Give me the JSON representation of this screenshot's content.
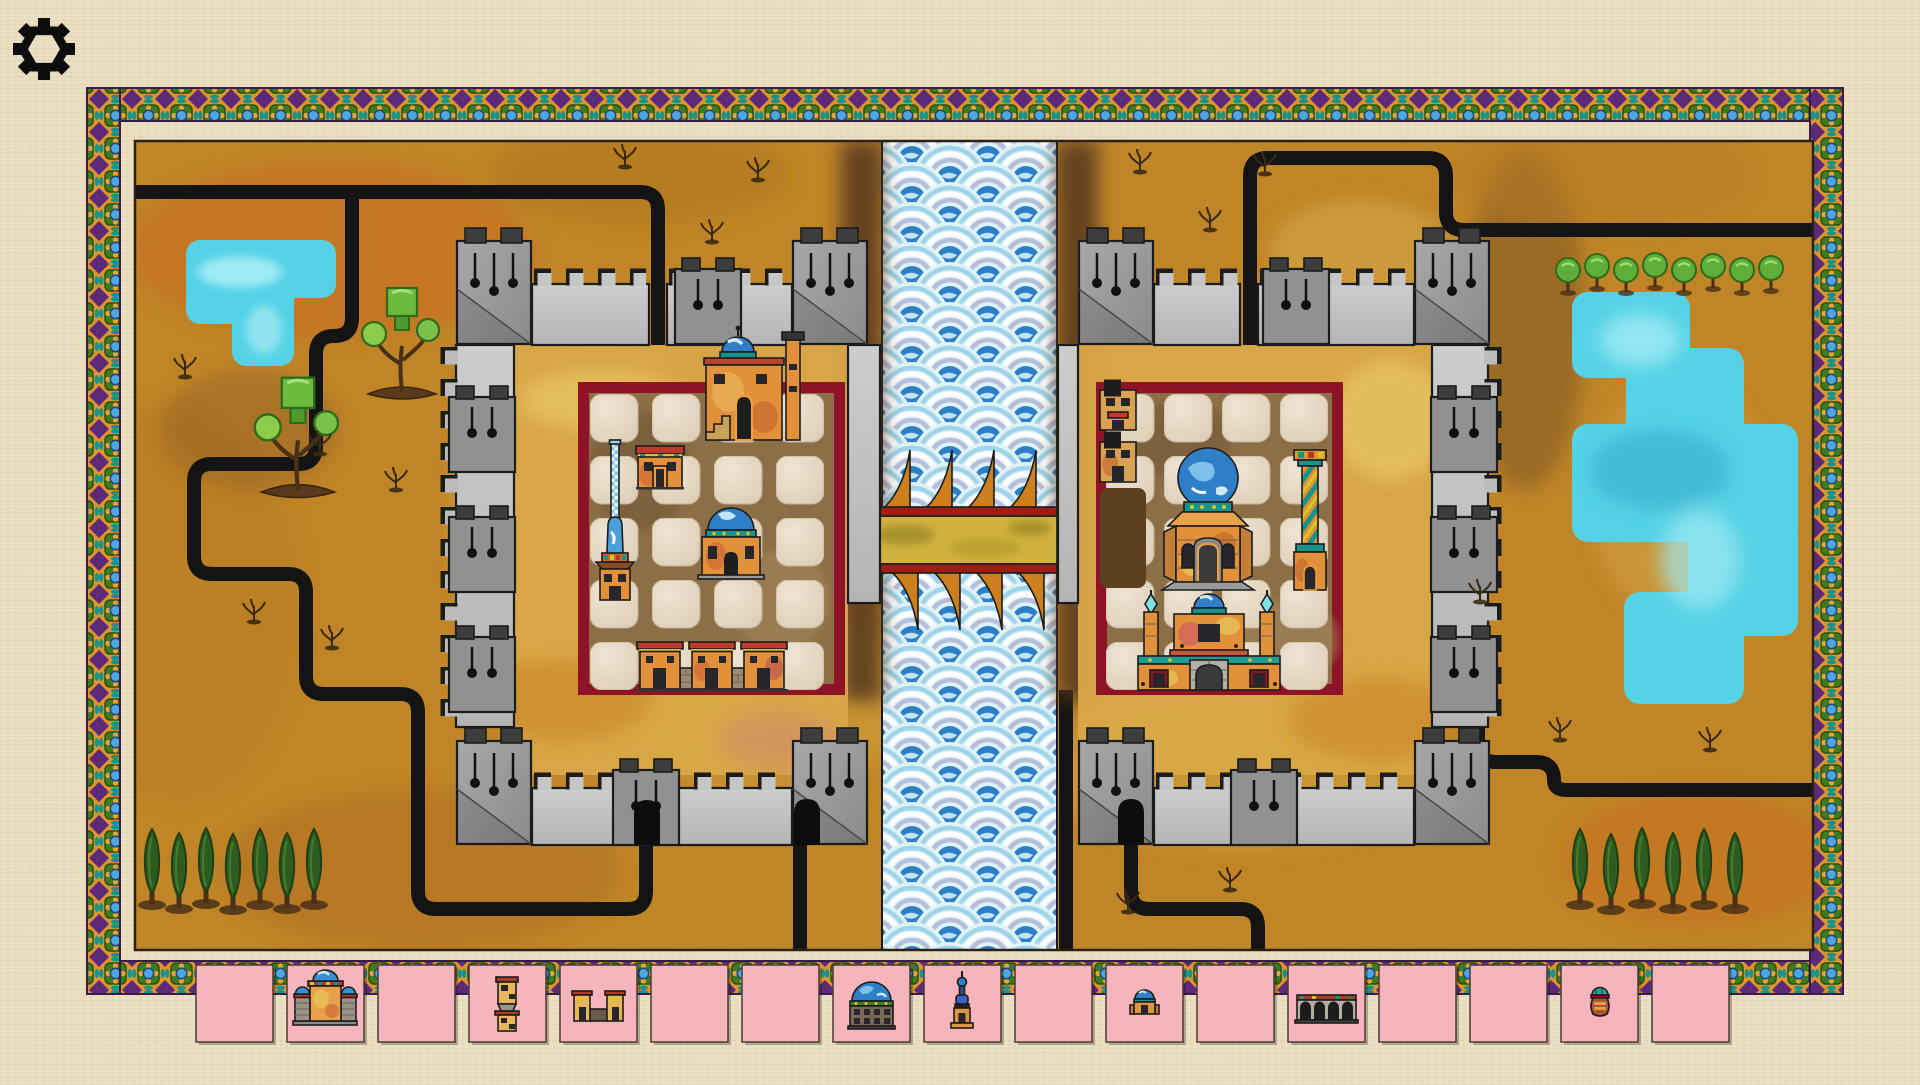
{
  "app": {
    "name": "Desert cities route-building board game",
    "background_color": "#ece0c3"
  },
  "toolbar": {
    "settings_icon": "gear"
  },
  "palette": {
    "paper": "#ece0c3",
    "board_gold": "#c08527",
    "road_black": "#141414",
    "lake_cyan": "#55d2e6",
    "river_blue": "#2e7fc8",
    "river_pale": "#dff2f7",
    "wall_light": "#c6c6c6",
    "wall_mid": "#9c9c9c",
    "battlement_dark": "#3d3d3d",
    "city_border_red": "#8e1326",
    "plaza_brown": "#8d6f47",
    "tile_slot": "#e9dcc9",
    "card_pink": "#f6b5bc",
    "bridge_gold": "#d2b23e",
    "bridge_red": "#9e1d15",
    "bridge_sail": "#cc7f1c",
    "frame_gold": "#e0942d",
    "frame_purple": "#5c2a78",
    "frame_green": "#3e7b1f",
    "frame_blue": "#4da6e0",
    "frame_teal": "#17948a",
    "tree_green": "#6cbb3c",
    "cypress_green": "#2e5c20",
    "building_orange": "#e2913a",
    "dome_blue": "#2e7fc8"
  },
  "board": {
    "left_province": {
      "features": [
        "stepped-lake",
        "ornamental-trees",
        "shrub-sprigs",
        "cypress-row",
        "winding-roads"
      ]
    },
    "river": {
      "style": "seigaiha-waves",
      "bridge": {
        "deck": "gold-planks",
        "rails": "red",
        "sails_top": 4,
        "sails_bottom": 4
      }
    },
    "right_province": {
      "features": [
        "round-tree-row",
        "stepped-lake",
        "shrub-sprigs",
        "cypress-row",
        "winding-roads"
      ]
    },
    "left_city": {
      "wall": "stone-with-towers",
      "gates": [
        "north",
        "south-west",
        "south-east"
      ],
      "plaza_slots": 20,
      "buildings": [
        {
          "name": "minaret"
        },
        {
          "name": "small-house"
        },
        {
          "name": "domed-house-with-chimney"
        },
        {
          "name": "domed-pavilion"
        },
        {
          "name": "row-houses"
        }
      ]
    },
    "right_city": {
      "wall": "stone-with-towers",
      "gates": [
        "north",
        "south",
        "south-outer"
      ],
      "plaza_slots": 20,
      "buildings": [
        {
          "name": "watchtowers"
        },
        {
          "name": "cleared-plot"
        },
        {
          "name": "great-domed-shrine"
        },
        {
          "name": "striped-column"
        },
        {
          "name": "gate-palace"
        }
      ]
    }
  },
  "market": {
    "cards": [
      {
        "slot": 1,
        "item": null
      },
      {
        "slot": 2,
        "item": "domed-palace"
      },
      {
        "slot": 3,
        "item": null
      },
      {
        "slot": 4,
        "item": "watchtower"
      },
      {
        "slot": 5,
        "item": "twin-tower-gate"
      },
      {
        "slot": 6,
        "item": null
      },
      {
        "slot": 7,
        "item": null
      },
      {
        "slot": 8,
        "item": "great-dome"
      },
      {
        "slot": 9,
        "item": "minaret"
      },
      {
        "slot": 10,
        "item": null
      },
      {
        "slot": 11,
        "item": "small-domed-house"
      },
      {
        "slot": 12,
        "item": null
      },
      {
        "slot": 13,
        "item": "aqueduct"
      },
      {
        "slot": 14,
        "item": null
      },
      {
        "slot": 15,
        "item": null
      },
      {
        "slot": 16,
        "item": "urn"
      },
      {
        "slot": 17,
        "item": null
      }
    ]
  }
}
